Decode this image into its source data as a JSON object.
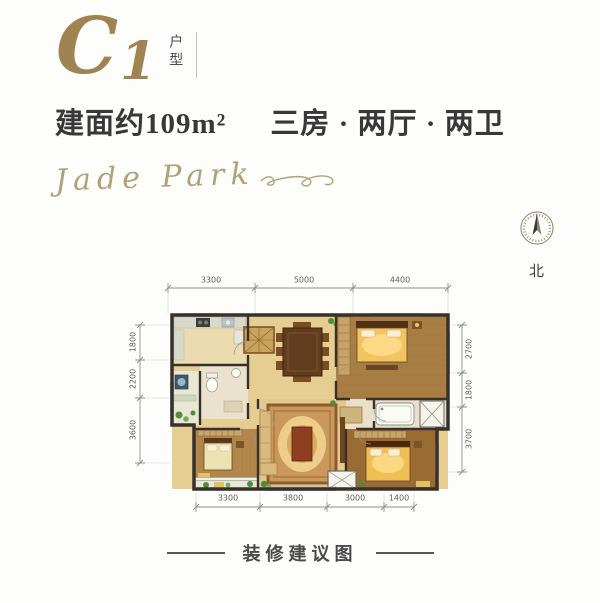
{
  "header": {
    "plan_code_letter": "C",
    "plan_code_number": "1",
    "plan_code_suffix": "户型",
    "area": "建面约109m²",
    "layout": "三房 · 两厅 · 两卫",
    "logo": "Jade Park"
  },
  "compass": {
    "label": "北"
  },
  "plan": {
    "dims_top": [
      "3300",
      "5000",
      "4400"
    ],
    "dims_bottom": [
      "3300",
      "3800",
      "3000",
      "1400"
    ],
    "dims_left": [
      "1800",
      "2200",
      "3600"
    ],
    "dims_right": [
      "2700",
      "1800",
      "3700"
    ]
  },
  "footer": {
    "caption": "装修建议图"
  },
  "colors": {
    "accent_bronze": "#a08352",
    "logo_gold": "#b1a176",
    "text_dark": "#383838",
    "dim_text": "#5d5d5d",
    "wall": "#38302a",
    "floor_tan": "#e6cd92",
    "wood_floor": "#a87e44",
    "bed_gold": "#f1c45f"
  }
}
